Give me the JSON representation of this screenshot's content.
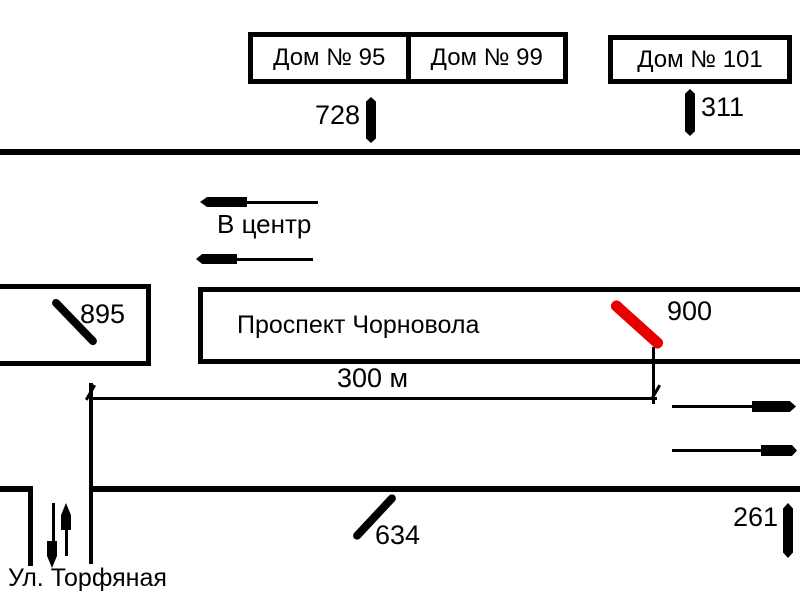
{
  "scene": {
    "background_color": "#ffffff",
    "ink_color": "#000000",
    "highlight_color": "#e60000"
  },
  "houses": {
    "h95": "Дом № 95",
    "h99": "Дом № 99",
    "h101": "Дом № 101"
  },
  "billboards": {
    "b728": "728",
    "b311": "311",
    "b895": "895",
    "b900": "900",
    "b634": "634",
    "b261": "261"
  },
  "labels": {
    "avenue": "Проспект Чорновола",
    "side_street": "Ул. Торфяная",
    "direction_to_center": "В центр",
    "distance": "300 м"
  }
}
